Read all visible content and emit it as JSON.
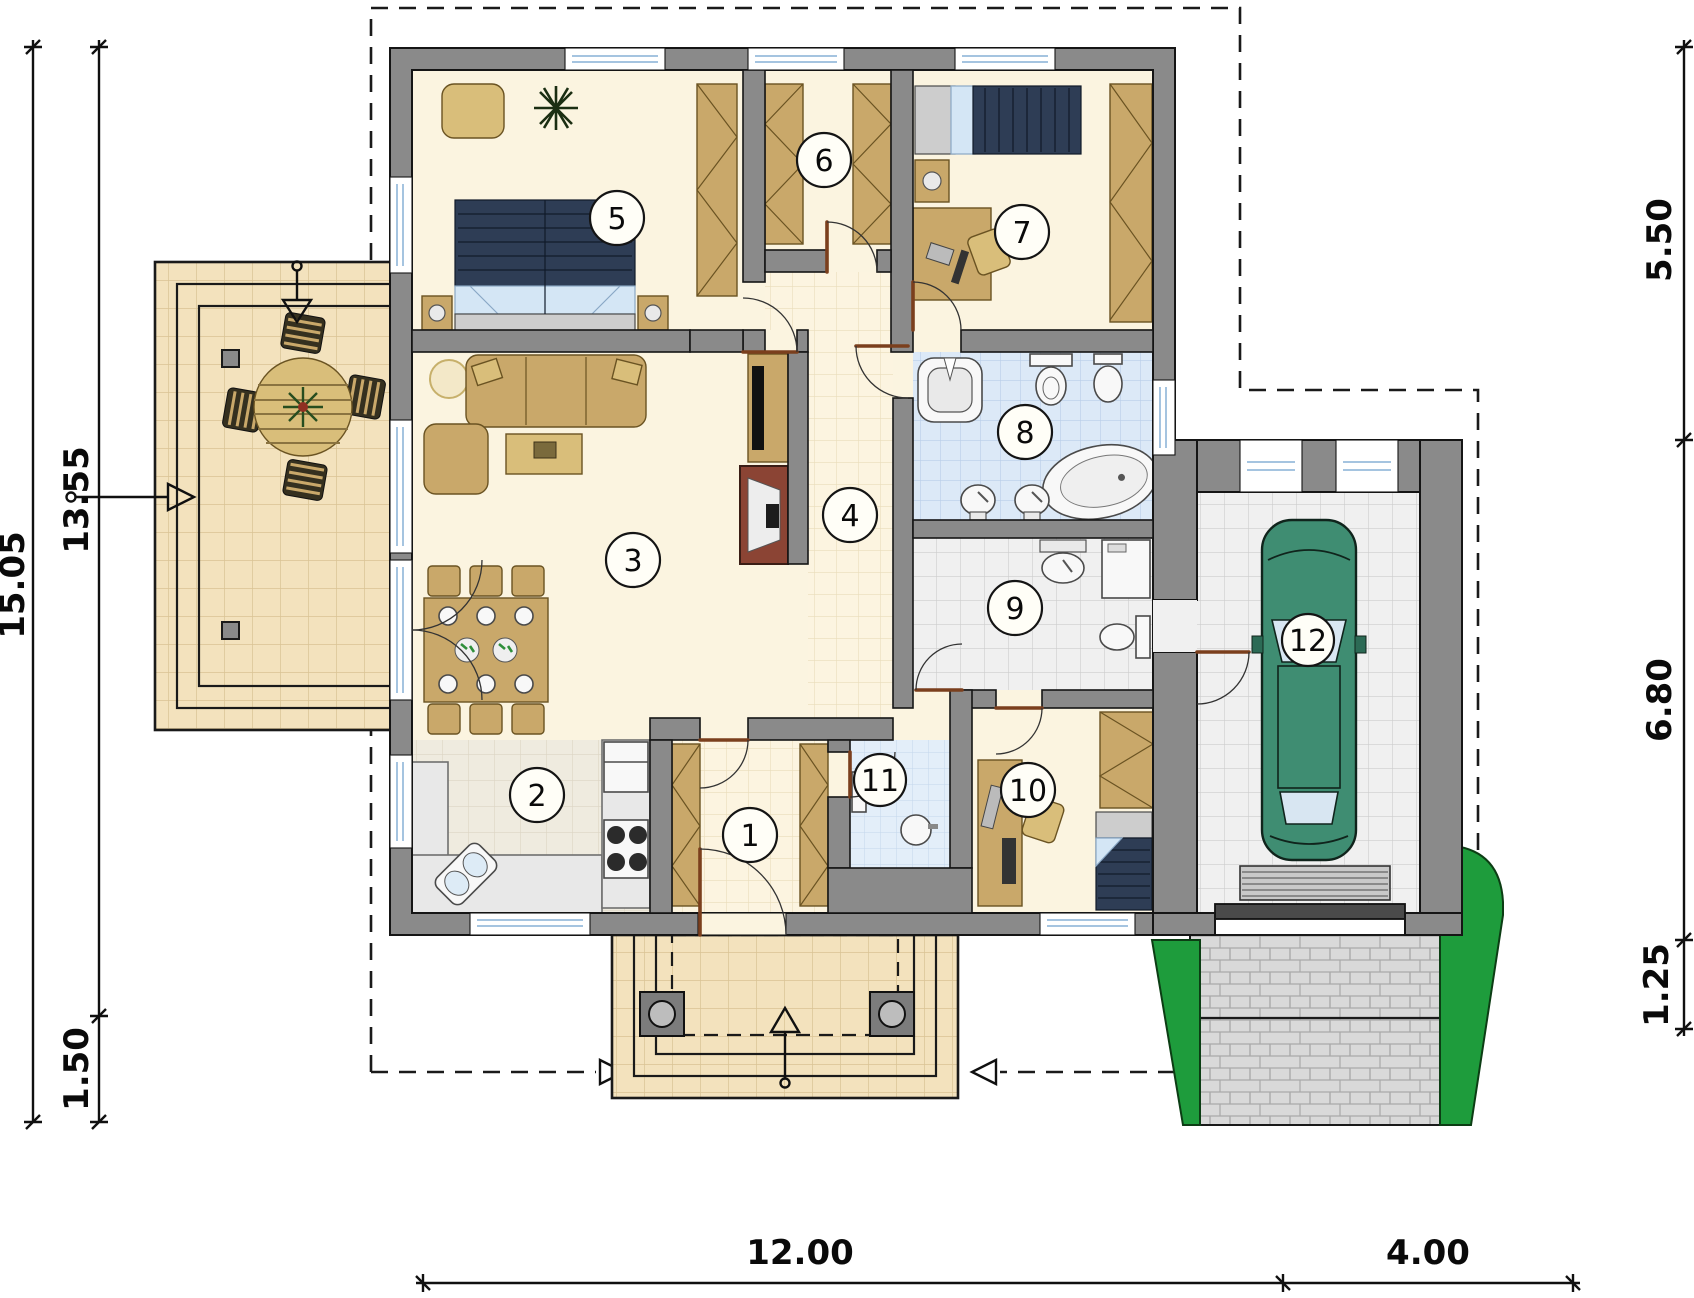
{
  "plan": {
    "type": "house-floor-plan",
    "room_labels": [
      "1",
      "2",
      "3",
      "4",
      "5",
      "6",
      "7",
      "8",
      "9",
      "10",
      "11",
      "12"
    ]
  },
  "dimensions": {
    "left": [
      "15.05",
      "13.55",
      "1.50"
    ],
    "right": [
      "5.50",
      "6.80",
      "1.25"
    ],
    "bottom": [
      "12.00",
      "4.00"
    ]
  },
  "colors": {
    "wall": "#8A8A8A",
    "floor": "#FBF4E0",
    "terrace_tile": "#F3E2BD",
    "hall_tile": "#FCF4E0",
    "bath_tile": "#DCE9F7",
    "gray_tile": "#F0F0F0",
    "furniture": "#C9A86A",
    "mattress": "#2E3D55",
    "bedding": "#D4E6F5",
    "car": "#3F8D72",
    "shrub": "#1E9C3C",
    "driveway_brick": "#D9D9D9",
    "door_leaf": "#7B3F1D",
    "dimension": "#101010"
  }
}
